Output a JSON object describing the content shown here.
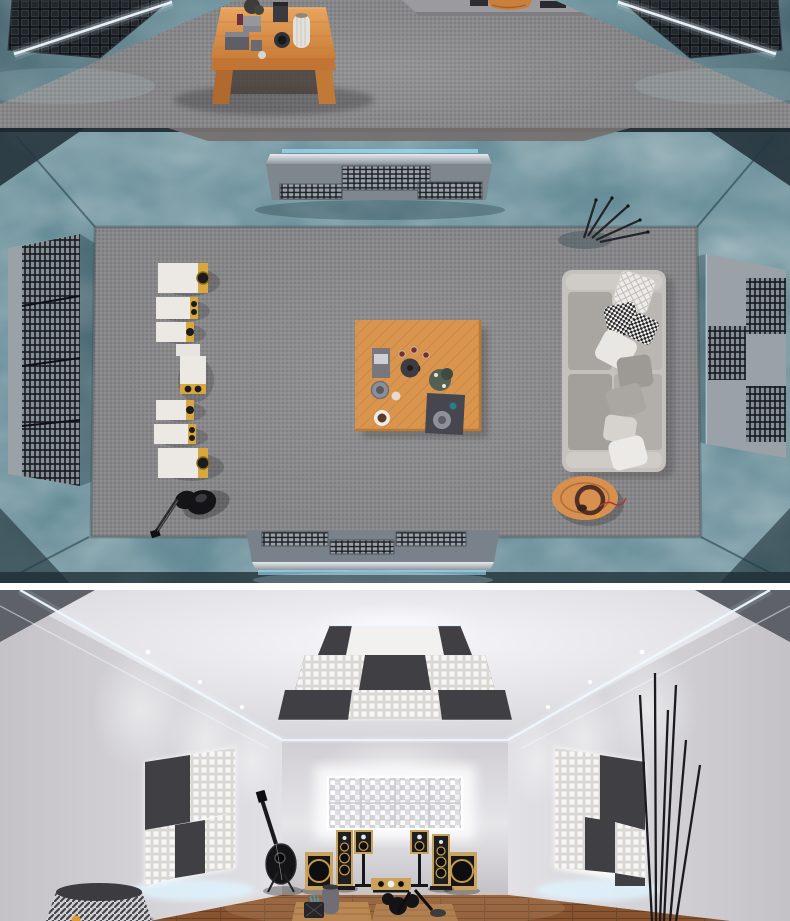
{
  "scene": {
    "kind": "acoustic-listening-room-3d-renders",
    "panels": [
      {
        "name": "render-closeup",
        "view": "eye-level close-up",
        "description": "Close-up render: wooden coffee table with vases, boxes and a plant on gray carpet; teal fabric walls left and right with black grid shelves outlined by white LED strips",
        "objects": [
          "gray-carpet-floor",
          "teal-fabric-wall-left",
          "teal-fabric-wall-right",
          "black-grid-shelf-left",
          "black-grid-shelf-right",
          "white-led-strip-left",
          "white-led-strip-right",
          "wooden-coffee-table",
          "white-ribbed-vase",
          "gray-box-stack",
          "dark-vase",
          "black-plant",
          "remote-control",
          "wooden-stool-edge"
        ]
      },
      {
        "name": "render-top-down",
        "view": "top-down plan",
        "description": "Top-down render of the listening room: column of seven white-and-gold speakers and a black guitar on the left, wooden coffee table with tea set at center, gray sofa with patterned pillows and round wooden side table with headphones on the right, metal grille absorber panels on the teal fabric walls, decorative branches in the corner",
        "objects": [
          "teal-fabric-walls",
          "gray-carpet-floor",
          "top-wall-grille-console",
          "bottom-wall-grille-console",
          "left-wall-grille-panel",
          "right-wall-grille-panel",
          "speaker-column",
          "black-guitar",
          "wooden-coffee-table",
          "tea-kettle",
          "plant-pot",
          "serving-tray",
          "gray-sofa",
          "pillows",
          "round-side-table",
          "headphones",
          "decor-branches"
        ]
      },
      {
        "name": "render-perspective",
        "view": "perspective interior",
        "description": "Perspective render of the finished room: checkerboard acoustic ceiling cloud with LED cove lighting and downlights, backlit checkerboard acoustic panels on side walls, glowing white diffuser wall at the back, two tower speakers, two stand-mounted monitors, two subwoofers and a center channel on a wood plank floor, acoustic guitar on a stand, patterned floor lamp and tall black decor sticks",
        "objects": [
          "ceiling-acoustic-cloud",
          "led-cove-strips",
          "downlights",
          "left-wall-acoustic-panel",
          "right-wall-acoustic-panel",
          "back-wall-diffuser",
          "tower-speaker-left",
          "tower-speaker-right",
          "monitor-speaker-left",
          "monitor-speaker-right",
          "subwoofer-left",
          "subwoofer-right",
          "center-channel-speaker",
          "acoustic-guitar",
          "floor-lamp",
          "decor-sticks",
          "audio-gear-pile",
          "wood-floor"
        ]
      }
    ]
  },
  "palette": {
    "teal_wall": "#3f6f7d",
    "teal_wall_deep": "#24505e",
    "carpet": "#87878a",
    "panel_metal": "#9aa2a8",
    "grille_dark": "#1d2125",
    "acoustic_dark": "#3f3f44",
    "acoustic_white": "#f2f1ef",
    "speaker_white": "#ece9e4",
    "speaker_gold": "#d9a73f",
    "sofa_gray": "#bab7b3",
    "wood_table": "#d9944e",
    "wood_floor": "#8a5531",
    "led_white": "#eef7ff",
    "led_cyan": "#9fe0f6",
    "black_gear": "#141416",
    "wall_light": "#d8d6da",
    "ceiling_light": "#e9e8ec",
    "divider_white": "#ffffff"
  }
}
